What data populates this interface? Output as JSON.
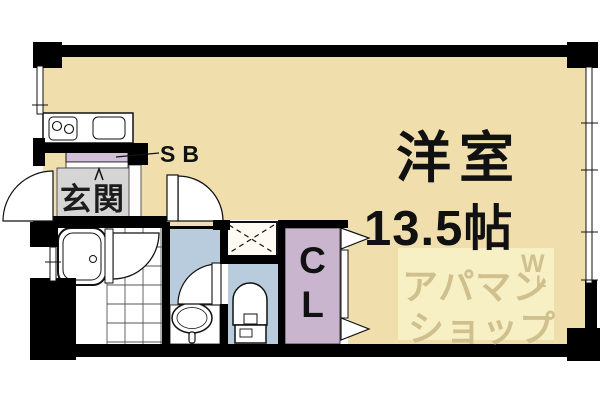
{
  "plan": {
    "type": "apartment-floor-plan",
    "labels": {
      "main_room": "洋室",
      "main_room_size": "13.5帖",
      "entrance": "玄関",
      "shoe_box": "SB",
      "closet_line1": "C",
      "closet_line2": "L"
    },
    "watermark": {
      "line1": "アパマン",
      "line2": "ショップ",
      "logo_top": "W",
      "logo_bottom": "L"
    },
    "fixtures": [
      "kitchen-counter",
      "two-burner-stove",
      "kitchen-sink",
      "bathtub",
      "bathroom-tile-floor",
      "washbasin",
      "toilet",
      "washing-machine-space",
      "entrance-door",
      "bathroom-door",
      "washroom-door",
      "toilet-door",
      "closet-folding-door",
      "windows"
    ],
    "colors": {
      "floor": "#f0dfad",
      "wet_area": "#b8ccdd",
      "closet": "#c9b6ce",
      "shoe_box": "#d2bfd8",
      "entrance_floor": "#d5d5d5",
      "wall": "#000000",
      "watermark_bg": "#f8f0c5",
      "watermark_text": "#cfc08e"
    }
  }
}
